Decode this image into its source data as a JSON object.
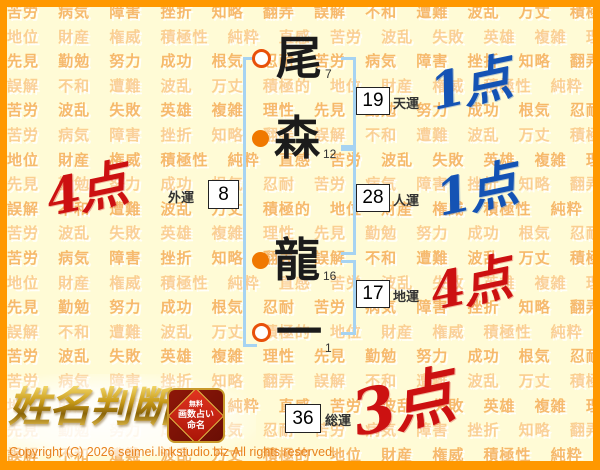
{
  "background": {
    "words": [
      "苦労",
      "病気",
      "障害",
      "挫折",
      "知略",
      "翻弄",
      "誤解",
      "不和",
      "遭難",
      "波乱",
      "万丈",
      "積極的",
      "地位",
      "財産",
      "権威",
      "積極性",
      "純粋",
      "直感",
      "苦労",
      "波乱",
      "失敗",
      "英雄",
      "複雑",
      "理性",
      "先見",
      "勤勉",
      "努力",
      "成功",
      "根気",
      "忍耐"
    ]
  },
  "name": {
    "characters": [
      {
        "char": "尾",
        "strokes": "7",
        "marker": "open"
      },
      {
        "char": "森",
        "strokes": "12",
        "marker": "filled"
      },
      {
        "char": "龍",
        "strokes": "16",
        "marker": "filled"
      },
      {
        "char": "一",
        "strokes": "1",
        "marker": "open"
      }
    ]
  },
  "fortunes": {
    "tenun": {
      "label": "天運",
      "value": "19",
      "score": "1点",
      "score_color": "#1453B4"
    },
    "jinun": {
      "label": "人運",
      "value": "28",
      "score": "1点",
      "score_color": "#1453B4"
    },
    "chiun": {
      "label": "地運",
      "value": "17",
      "score": "4点",
      "score_color": "#CC1111"
    },
    "gaiun": {
      "label": "外運",
      "value": "8",
      "score": "4点",
      "score_color": "#CC1111"
    },
    "souun": {
      "label": "総運",
      "value": "36",
      "score": "3点",
      "score_color": "#CC1111"
    }
  },
  "logo": {
    "title": "姓名判断",
    "badge": {
      "line1": "無料",
      "line2": "画数占い",
      "line3": "命名"
    }
  },
  "footer": {
    "copyright": "Copyright (C) 2026 seimei.linkstudio.biz All rights reserved."
  },
  "colors": {
    "page_background": "#FFFBD6",
    "frame": "#FF9800",
    "bracket": "#A6D3F2",
    "watermark_text": "#F3A64A",
    "good_score": "#1453B4",
    "bad_score": "#CC1111",
    "marker_orange": "#F07800"
  }
}
